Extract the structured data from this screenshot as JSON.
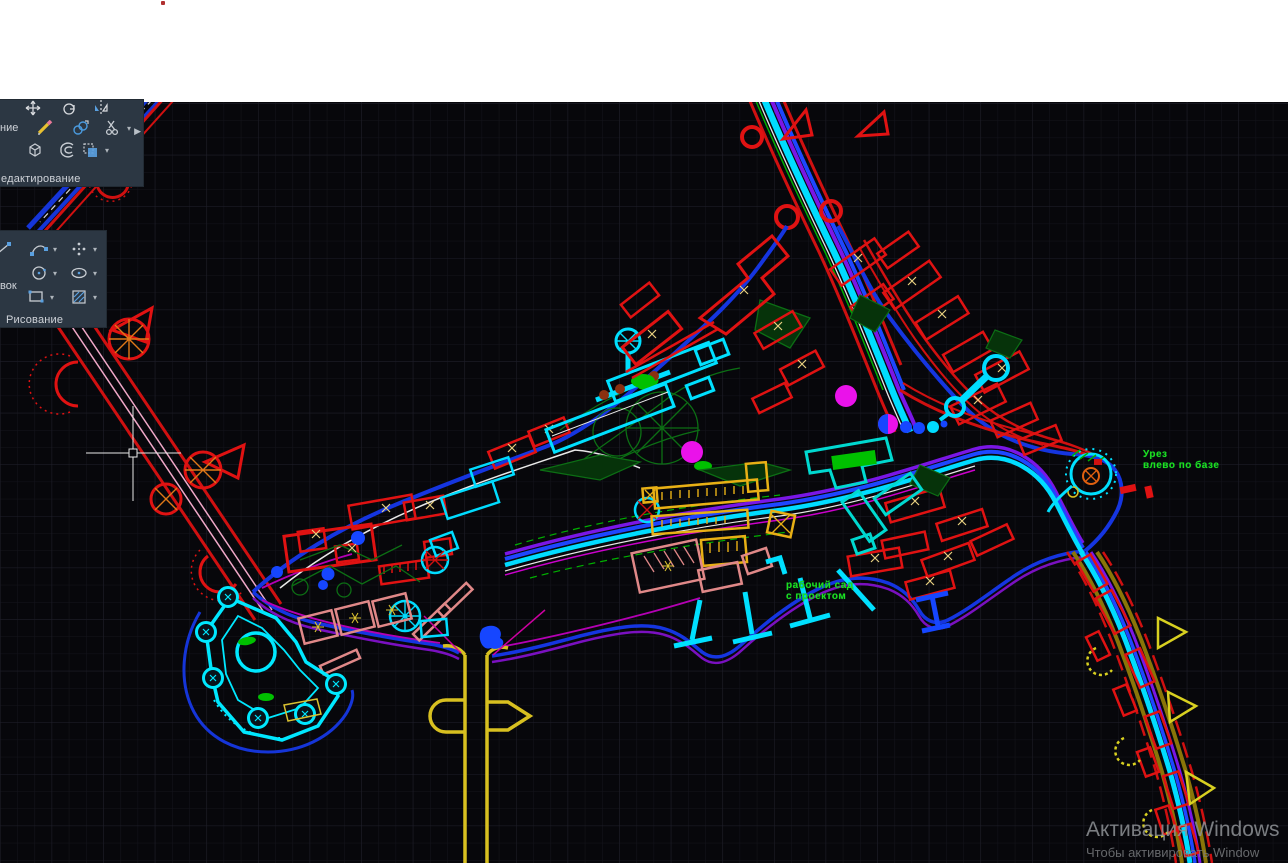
{
  "palette": {
    "canvas_bg": "#07070b",
    "grid_minor": "#14141c",
    "grid_major": "#1f1f2a",
    "panel_bg": "#2c3743",
    "panel_label": "#cfd3d9",
    "annotation_green": "#1ee11e",
    "watermark_gray": "#8f9296",
    "red": "#e01212",
    "cyan": "#00dcff",
    "blue": "#1e46ff",
    "violet": "#7a16e6",
    "magenta": "#ea12ea",
    "gold": "#e8b015",
    "salmon": "#e08888",
    "olive": "#8a7508",
    "dark_green": "#0c6e14",
    "yellow": "#d8c020",
    "white_line": "#e8e8e8"
  },
  "ribbon": {
    "caret": "▾",
    "flyout_arrow": "▶",
    "modify_panel": {
      "label": "едактирование",
      "edge_label": "ние",
      "tools": [
        "move-tool",
        "rotate-tool",
        "mirror-tool",
        "erase-tool",
        "copy-tool",
        "trim-tool",
        "explode-tool",
        "offset-tool",
        "stretch-tool"
      ]
    },
    "draw_panel": {
      "label": "Рисование",
      "edge_label": "вок",
      "tools": [
        "line-tool",
        "arc-tool",
        "point-tool",
        "circle-tool",
        "ellipse-tool",
        "rectangle-tool",
        "hatch-tool"
      ]
    }
  },
  "annotations": {
    "color": "#1ee11e",
    "right_note": {
      "line1": "Урез",
      "line2": "влево по базе"
    },
    "center_note": {
      "line1": "рабочий сад",
      "line2": "с проектом"
    }
  },
  "watermark": {
    "title": "Активация Windows",
    "subtitle": "Чтобы активировать Window",
    "color": "#8f9296"
  }
}
